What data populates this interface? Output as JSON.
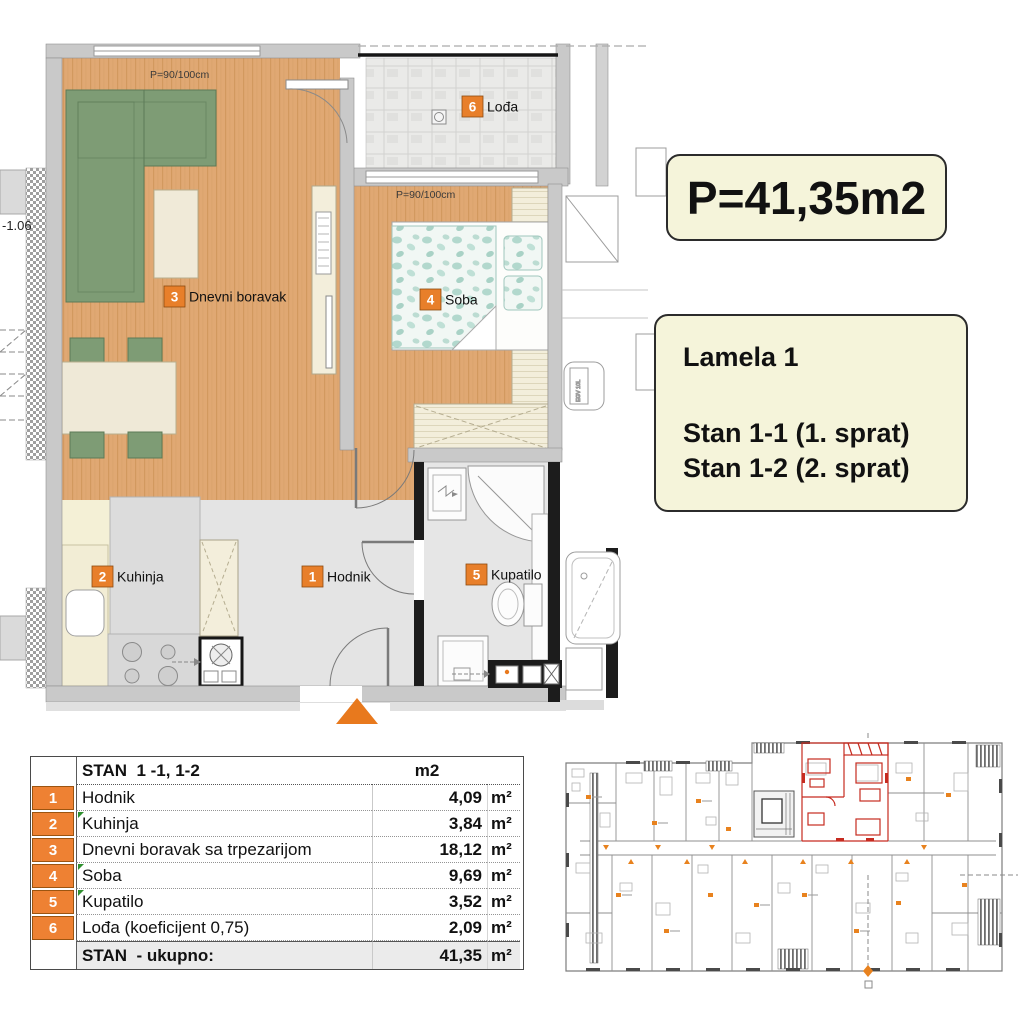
{
  "plan": {
    "window_label": "P=90/100cm",
    "level_label": "-1.06",
    "heater_label": "EGV 10L",
    "rooms": [
      {
        "num": "1",
        "name": "Hodnik"
      },
      {
        "num": "2",
        "name": "Kuhinja"
      },
      {
        "num": "3",
        "name": "Dnevni boravak"
      },
      {
        "num": "4",
        "name": "Soba"
      },
      {
        "num": "5",
        "name": "Kupatilo"
      },
      {
        "num": "6",
        "name": "Lođa"
      }
    ]
  },
  "info": {
    "area": "P=41,35m2",
    "building": "Lamela 1",
    "unit1": "Stan 1-1 (1. sprat)",
    "unit2": "Stan 1-2 (2. sprat)"
  },
  "table": {
    "header": {
      "title": "STAN  1 -1, 1-2",
      "unit_col": "m2"
    },
    "rows": [
      {
        "num": "1",
        "name": "Hodnik",
        "value": "4,09",
        "unit": "m²",
        "marker": false
      },
      {
        "num": "2",
        "name": "Kuhinja",
        "value": "3,84",
        "unit": "m²",
        "marker": true
      },
      {
        "num": "3",
        "name": "Dnevni boravak sa trpezarijom",
        "value": "18,12",
        "unit": "m²",
        "marker": false
      },
      {
        "num": "4",
        "name": "Soba",
        "value": "9,69",
        "unit": "m²",
        "marker": true
      },
      {
        "num": "5",
        "name": "Kupatilo",
        "value": "3,52",
        "unit": "m²",
        "marker": true
      },
      {
        "num": "6",
        "name": "Lođa (koeficijent 0,75)",
        "value": "2,09",
        "unit": "m²",
        "marker": false
      }
    ],
    "total": {
      "name": "STAN  - ukupno:",
      "value": "41,35",
      "unit": "m²"
    }
  },
  "colors": {
    "badge_orange": "#ee8133",
    "entrance_arrow_orange": "#e8791d",
    "info_box_bg": "#f5f4da",
    "highlight_red": "#c62b20",
    "sofa_green": "#7e9c75",
    "wood_floor": "#e0a873",
    "marker_green": "#2f8f2f"
  }
}
